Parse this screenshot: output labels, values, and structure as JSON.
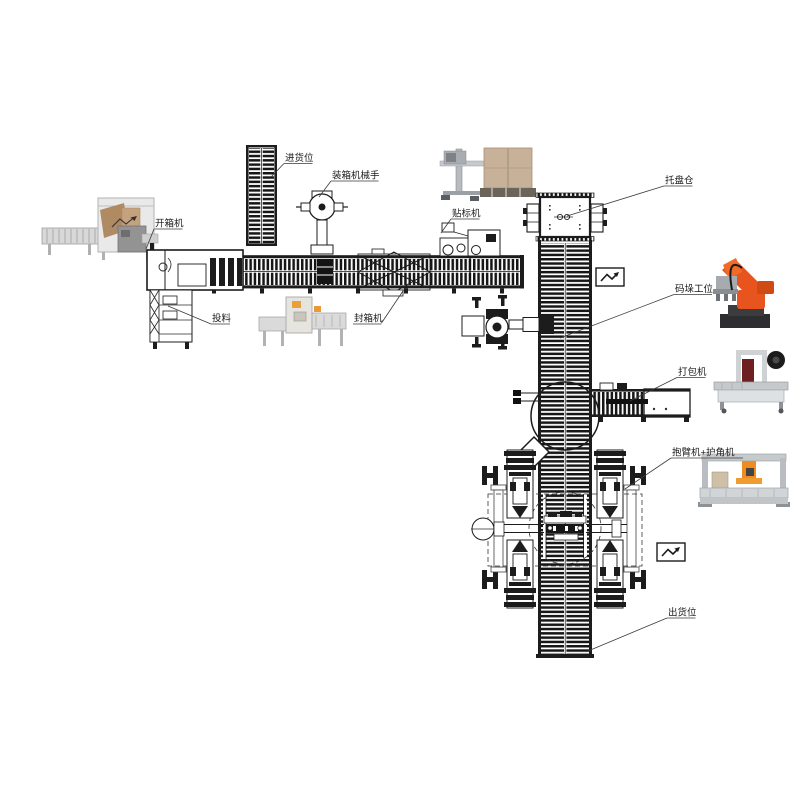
{
  "page": {
    "background": "#ffffff"
  },
  "diagram": {
    "name": "automated-packaging-palletizing-line-layout",
    "labels": {
      "infeed": "进货位",
      "packing_robot": "装箱机械手",
      "case_erector": "开箱机",
      "feeding": "投料",
      "case_sealer": "封箱机",
      "labeler": "贴标机",
      "pallet_magazine": "托盘仓",
      "palletizing_station": "码垛工位",
      "strapper": "打包机",
      "clamp_corner": "抱臂机+护角机",
      "outfeed": "出货位"
    },
    "symbols": {
      "flow_break": "zigzag-arrow"
    },
    "photos": {
      "case_erector": "case-erector-machine-photo",
      "case_sealer": "case-sealer-machine-photo",
      "labeler": "labeling-machine-photo",
      "palletizing_robot": "orange-palletizing-robot-photo",
      "strapper": "strapping-machine-photo",
      "clamp_corner": "gantry-strapper-corner-machine-photo"
    },
    "colors": {
      "line_art": "#1c1c1c",
      "robot_orange": "#e8541d",
      "machine_gray": "#d5d5d5",
      "carton_brown": "#bf9d7a",
      "label_text": "#1a1a1a"
    }
  }
}
